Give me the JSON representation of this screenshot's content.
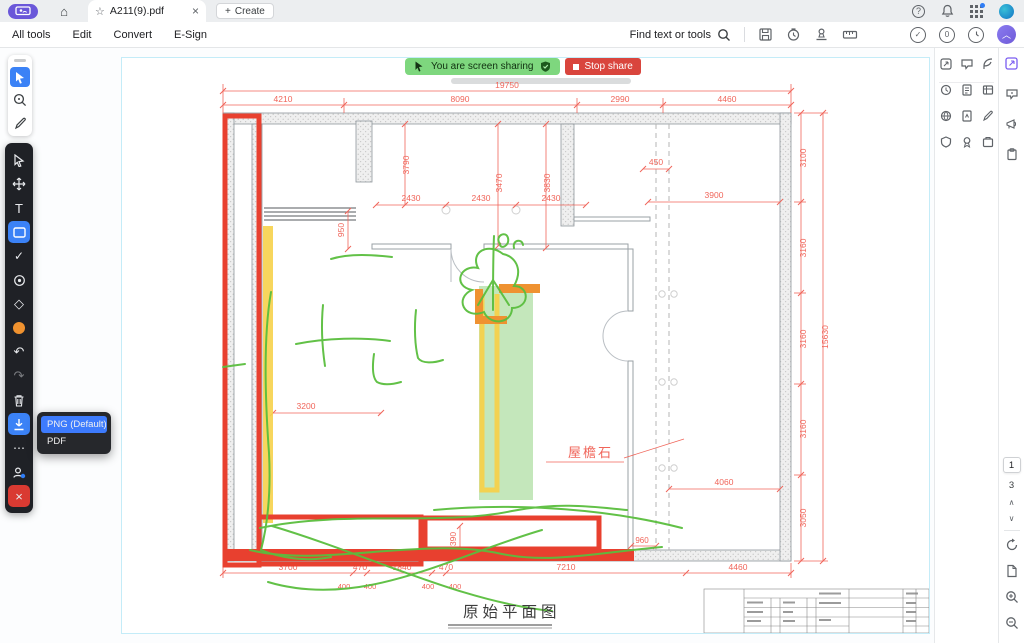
{
  "tabbar": {
    "tab_title": "A211(9).pdf",
    "create_label": "Create"
  },
  "menubar": {
    "items": [
      "All tools",
      "Edit",
      "Convert",
      "E-Sign"
    ],
    "find_label": "Find text or tools"
  },
  "share_banner": {
    "message": "You are screen sharing",
    "stop_label": "Stop share"
  },
  "download_menu": {
    "items": [
      "PNG (Default)",
      "PDF"
    ]
  },
  "page_nav": {
    "current": "1",
    "total": "3"
  },
  "plan": {
    "dims": {
      "top_total": "19750",
      "top": [
        "4210",
        "8090",
        "2990",
        "4460"
      ],
      "right": [
        "3100",
        "3160",
        "3160",
        "3160",
        "3050"
      ],
      "right_total": "15630",
      "bottom": [
        "3700",
        "470",
        "1840",
        "470",
        "7210",
        "4460"
      ],
      "bottom_sub": [
        "400",
        "400",
        "400",
        "400"
      ],
      "v": [
        "3790",
        "3470",
        "3830"
      ],
      "h2430": [
        "2430",
        "2430",
        "2430"
      ],
      "d450": "450",
      "d3900": "3900",
      "d950": "950",
      "d3200": "3200",
      "d4060": "4060",
      "d960": "960",
      "d390": "390"
    },
    "labels": {
      "eave": "屋檐石",
      "title": "原始平面图"
    }
  },
  "colors": {
    "annotation_red": "#e8402f",
    "dimension_red": "#f0655a",
    "highlight_yellow": "#f6d14b",
    "highlight_green": "#7cc969",
    "highlight_orange": "#ef9231",
    "scribble_green": "#5abe3e",
    "banner_green": "#7ed77e",
    "stop_red": "#d9453d",
    "accent_blue": "#3b82f6",
    "indicator_purple": "#6a57d9"
  }
}
